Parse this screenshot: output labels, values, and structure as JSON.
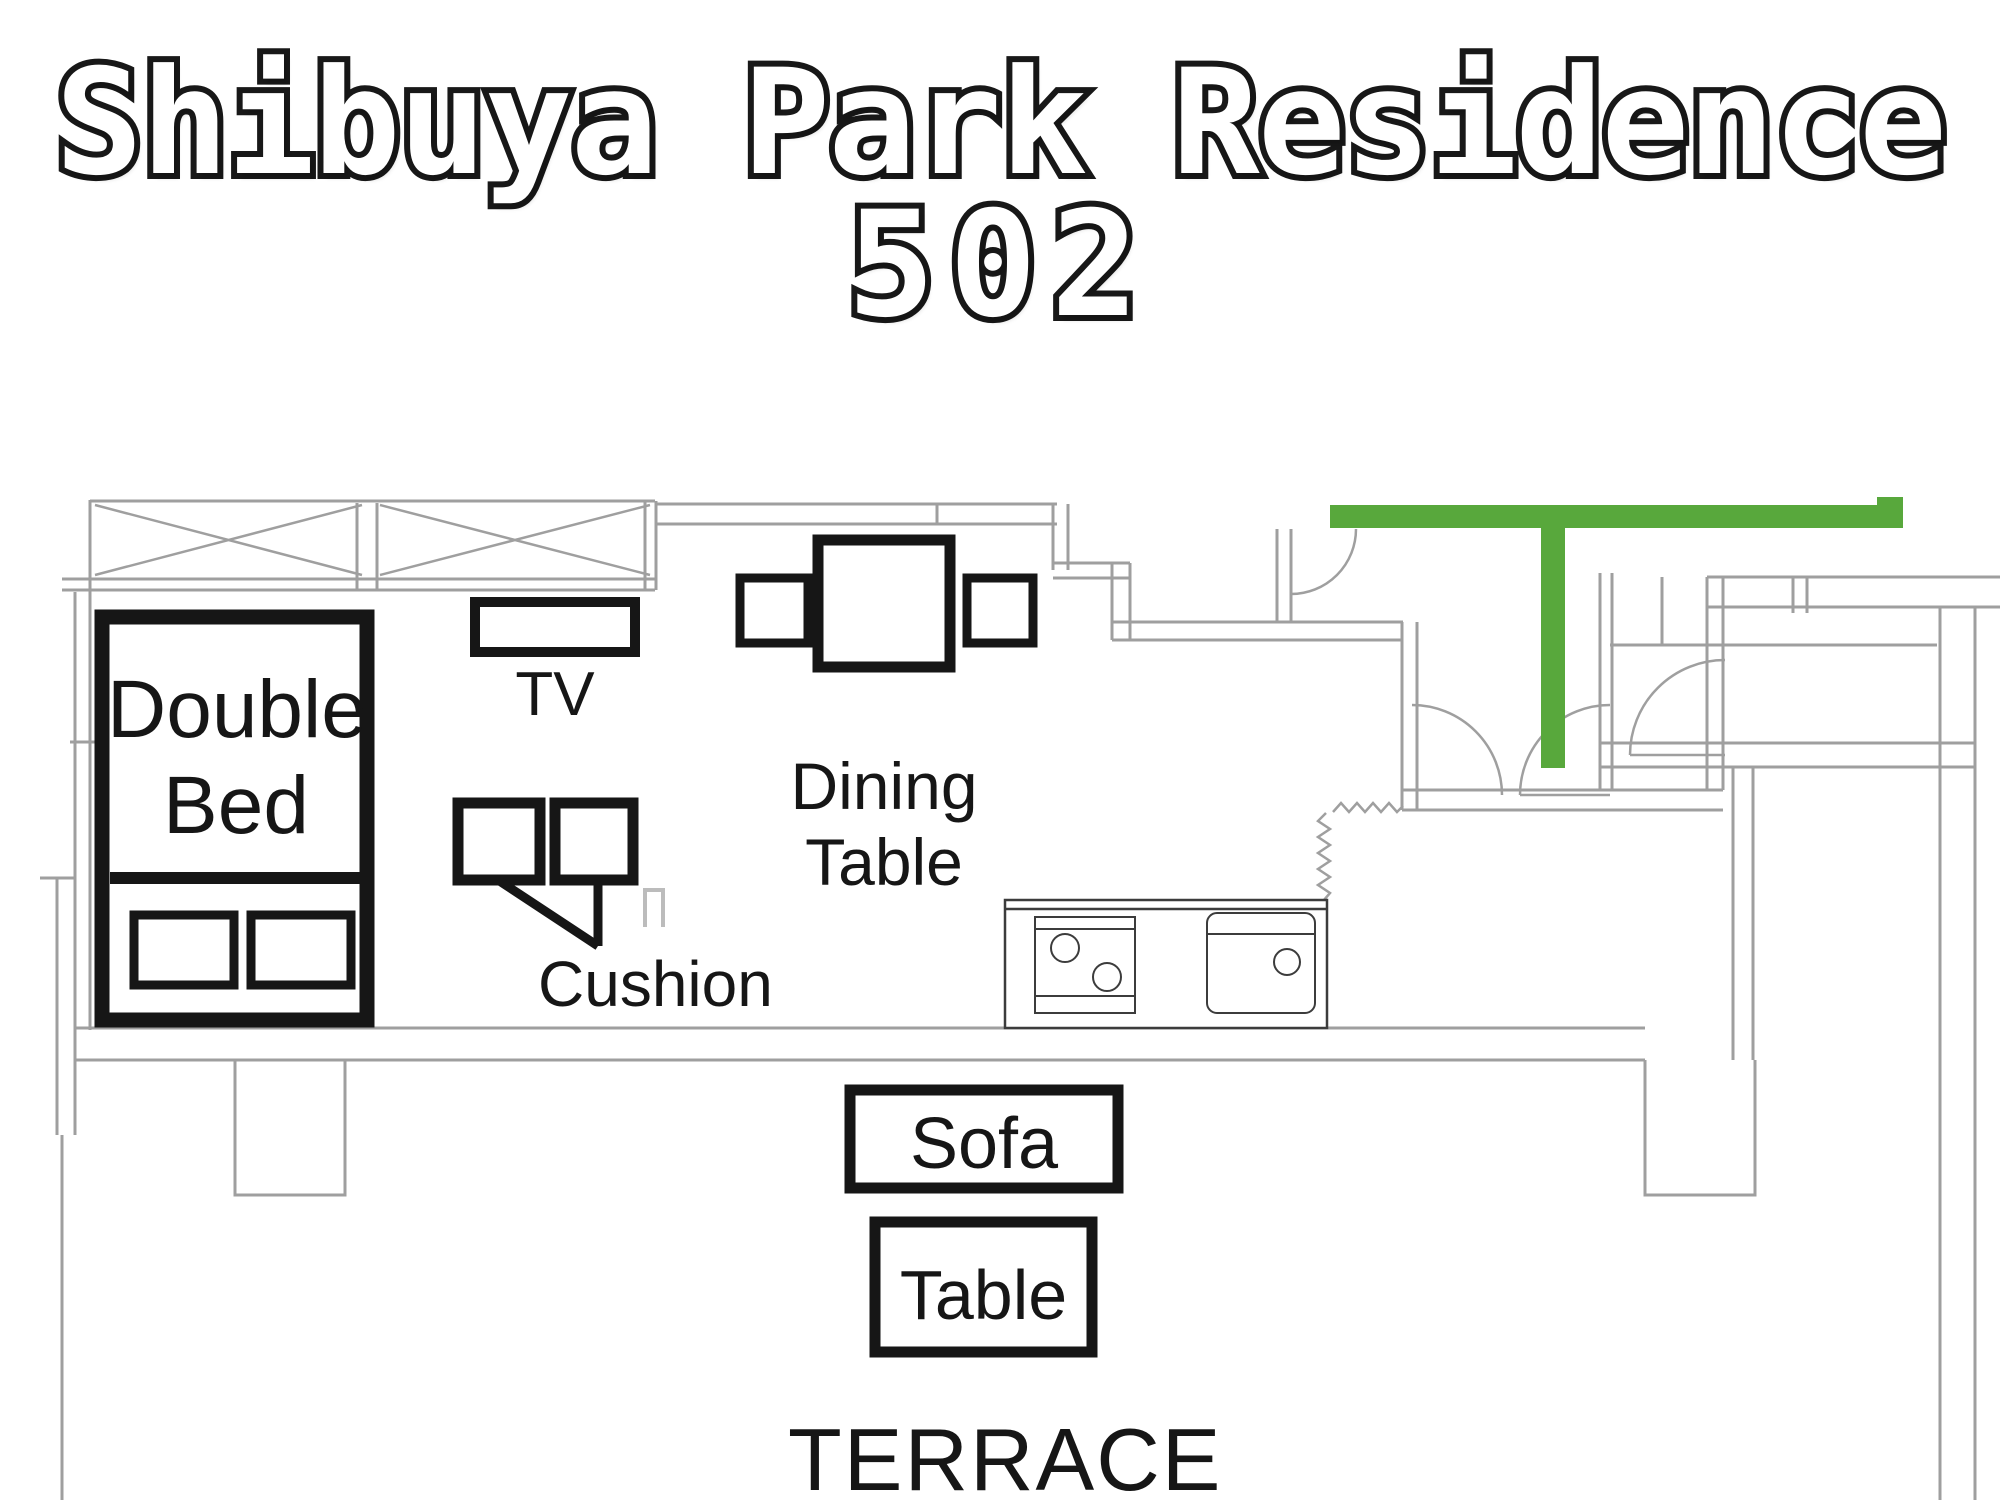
{
  "title": {
    "line1": "Shibuya Park Residence",
    "line2": "502"
  },
  "floor_plan": {
    "furniture": {
      "double_bed": {
        "label_line1": "Double",
        "label_line2": "Bed"
      },
      "tv": {
        "label": "TV"
      },
      "cushion": {
        "label": "Cushion"
      },
      "dining_table": {
        "label_line1": "Dining",
        "label_line2": "Table"
      },
      "sofa": {
        "label": "Sofa"
      },
      "table": {
        "label": "Table"
      }
    },
    "areas": {
      "terrace": {
        "label": "TERRACE"
      }
    }
  },
  "colors": {
    "background": "#ffffff",
    "ink": "#161616",
    "wall_gray": "#9f9f9f",
    "wall_gray_light": "#bcbcbc",
    "kitchen_line": "#3c3c3c",
    "accent_green": "#58a83c"
  }
}
